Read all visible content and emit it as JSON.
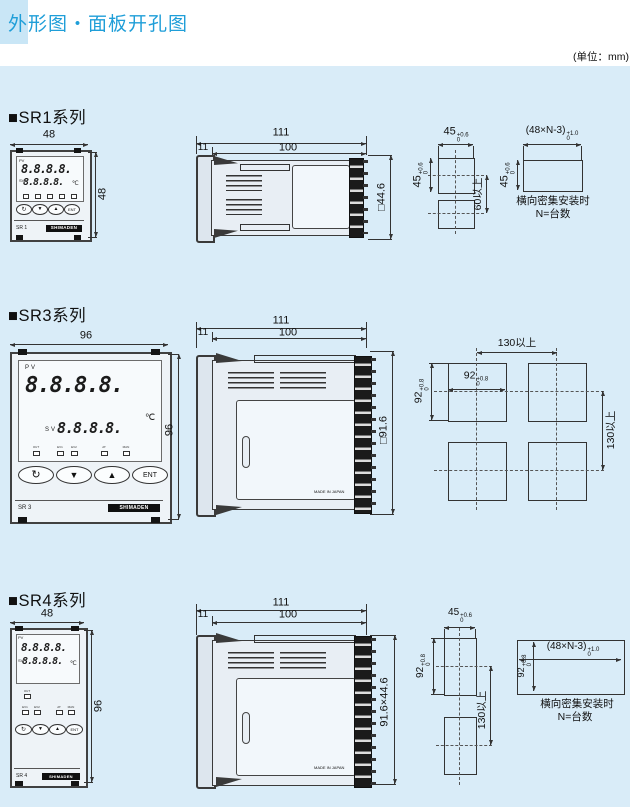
{
  "page": {
    "title": "外形图・面板开孔图",
    "unit_note": "(单位：mm)"
  },
  "device": {
    "pv": "PV",
    "sv": "SV",
    "display": "8.8.8.8.",
    "celsius": "℃",
    "btn_loop": "↻",
    "btn_down": "▼",
    "btn_up": "▲",
    "btn_ent": "ENT",
    "brand": "SHIMADEN",
    "made_in": "MADE IN JAPAN",
    "indicators": [
      "OUT",
      "EV1",
      "EV2",
      "AT",
      "MAN"
    ]
  },
  "sr1": {
    "heading": "■SR1系列",
    "model": "SR 1",
    "front_w": "48",
    "front_h": "48",
    "depth_total": "111",
    "depth_body": "100",
    "depth_bezel": "11",
    "side_h": "□44.6",
    "cut": {
      "w": "45",
      "w_sup": "+0.6",
      "w_sub": "0",
      "h": "45",
      "h_sup": "+0.6",
      "h_sub": "0",
      "pitch_v": "60以上"
    },
    "dense": {
      "w": "(48×N-3)",
      "w_sup": "+1.0",
      "w_sub": "0",
      "h": "45",
      "h_sup": "+0.6",
      "h_sub": "0",
      "note1": "横向密集安装时",
      "note2": "N=台数"
    }
  },
  "sr3": {
    "heading": "■SR3系列",
    "model": "SR 3",
    "front_w": "96",
    "front_h": "96",
    "depth_total": "111",
    "depth_body": "100",
    "depth_bezel": "11",
    "side_h": "□91.6",
    "cut": {
      "w": "92",
      "w_sup": "+0.8",
      "w_sub": "0",
      "h": "92",
      "h_sup": "+0.8",
      "h_sub": "0",
      "pitch_h": "130以上",
      "pitch_v": "130以上"
    }
  },
  "sr4": {
    "heading": "■SR4系列",
    "model": "SR 4",
    "front_w": "48",
    "front_h": "96",
    "depth_total": "111",
    "depth_body": "100",
    "depth_bezel": "11",
    "side_h": "91.6×44.6",
    "cut": {
      "w": "45",
      "w_sup": "+0.6",
      "w_sub": "0",
      "h": "92",
      "h_sup": "+0.8",
      "h_sub": "0",
      "pitch_v": "130以上"
    },
    "dense": {
      "w": "(48×N-3)",
      "w_sup": "+1.0",
      "w_sub": "0",
      "h": "92",
      "h_sup": "+0.8",
      "h_sub": "0",
      "note1": "横向密集安装时",
      "note2": "N=台数"
    }
  }
}
